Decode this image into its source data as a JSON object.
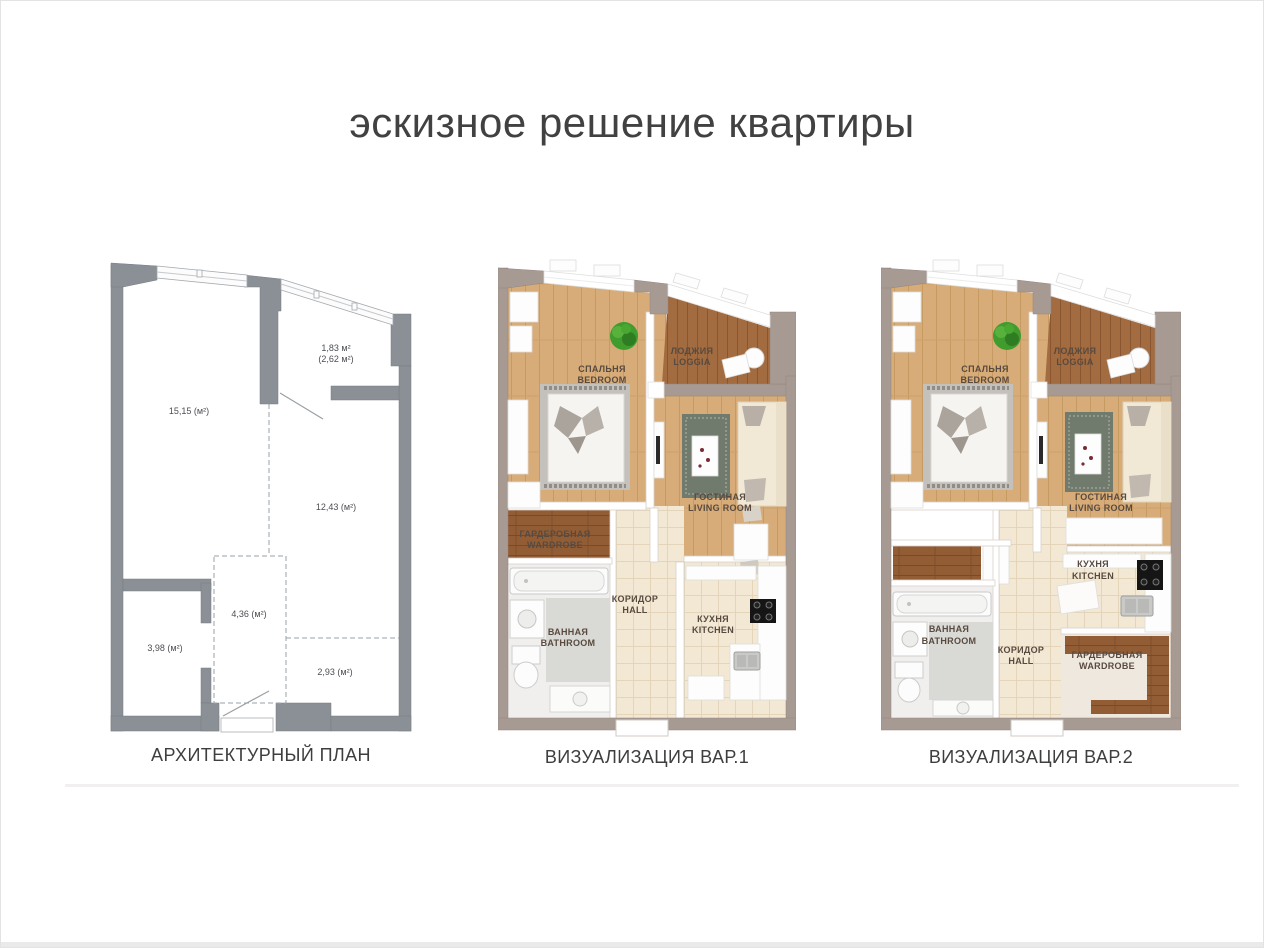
{
  "title": "эскизное решение квартиры",
  "plan": {
    "caption": "АРХИТЕКТУРНЫЙ ПЛАН",
    "areas": {
      "loggia_small": "1,83 м²",
      "loggia_full": "(2,62 м²)",
      "bedroom": "15,15 (м²)",
      "living": "12,43 (м²)",
      "hall": "4,36 (м²)",
      "bathroom": "3,98 (м²)",
      "kitchen": "2,93 (м²)"
    }
  },
  "viz1": {
    "caption": "ВИЗУАЛИЗАЦИЯ ВАР.1",
    "rooms": {
      "bedroom": {
        "ru": "СПАЛЬНЯ",
        "en": "BEDROOM"
      },
      "loggia": {
        "ru": "ЛОДЖИЯ",
        "en": "LOGGIA"
      },
      "living": {
        "ru": "ГОСТИНАЯ",
        "en": "LIVING ROOM"
      },
      "wardrobe": {
        "ru": "ГАРДЕРОБНАЯ",
        "en": "WARDROBE"
      },
      "bathroom": {
        "ru": "ВАННАЯ",
        "en": "BATHROOM"
      },
      "hall": {
        "ru": "КОРИДОР",
        "en": "HALL"
      },
      "kitchen": {
        "ru": "КУХНЯ",
        "en": "KITCHEN"
      }
    }
  },
  "viz2": {
    "caption": "ВИЗУАЛИЗАЦИЯ ВАР.2",
    "rooms": {
      "bedroom": {
        "ru": "СПАЛЬНЯ",
        "en": "BEDROOM"
      },
      "loggia": {
        "ru": "ЛОДЖИЯ",
        "en": "LOGGIA"
      },
      "living": {
        "ru": "ГОСТИНАЯ",
        "en": "LIVING ROOM"
      },
      "kitchen": {
        "ru": "КУХНЯ",
        "en": "KITCHEN"
      },
      "bathroom": {
        "ru": "ВАННАЯ",
        "en": "BATHROOM"
      },
      "hall": {
        "ru": "КОРИДОР",
        "en": "HALL"
      },
      "wardrobe": {
        "ru": "ГАРДЕРОБНАЯ",
        "en": "WARDROBE"
      }
    }
  },
  "colors": {
    "plan_wall": "#8a9096",
    "viz_wall": "#a79a93",
    "wood_floor": "#d7ac78",
    "loggia_wood": "#a26b40",
    "dark_wood": "#925d35",
    "tile_floor": "#f3e8d4",
    "plant_green": "#3f9c2d",
    "text_dark": "#3e3e3e",
    "label_brown": "#584a3f"
  }
}
